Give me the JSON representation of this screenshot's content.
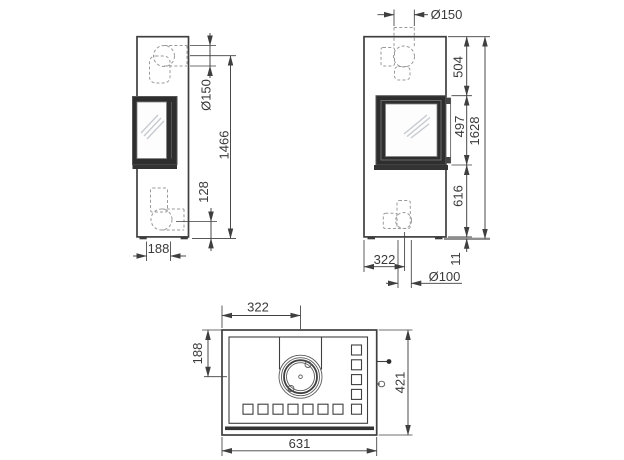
{
  "colors": {
    "line": "#3f3f3f",
    "hidden_line": "#9a9a9a",
    "text": "#3a3a3a",
    "door_fill": "#2e2e2e",
    "glass": "#fdfdfd",
    "floor_line": "#8f8f8f",
    "background": "#ffffff"
  },
  "dims": {
    "side_flue_diameter": "Ø150",
    "side_flue_center_height": "1466",
    "side_rear_outlet_height": "128",
    "side_outlet_offset": "188",
    "front_flue_diameter": "Ø150",
    "front_top_section": "504",
    "front_door_height": "497",
    "front_total_height": "1628",
    "front_lower_section": "616",
    "front_feet_height": "11",
    "front_outlet_offset": "322",
    "front_bottom_outlet_diameter": "Ø100",
    "top_collar_offset_x": "322",
    "top_collar_offset_y": "188",
    "top_depth": "421",
    "top_width": "631"
  }
}
